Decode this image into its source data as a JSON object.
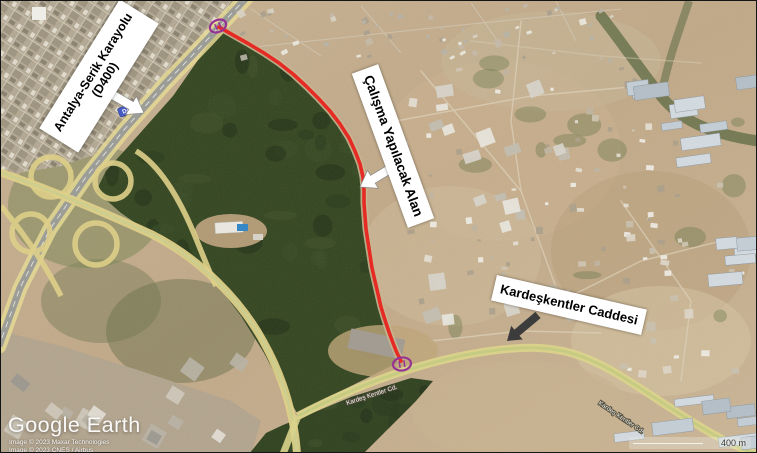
{
  "figure": {
    "callouts": {
      "highway": {
        "line1": "Antalya-Serik Karayolu",
        "line2": "(D400)"
      },
      "work_area": {
        "text": "Çalışma Yapılacak Alan"
      },
      "street": {
        "text": "Kardeşkentler Caddesi"
      }
    },
    "map": {
      "road_shield": "D400",
      "on_road_labels": [
        "Kardeş Kentler Cd.",
        "Kardeş Kentler Cd."
      ],
      "scale_label": "400 m",
      "watermark": "Google Earth",
      "attribution": [
        "Image © 2023 Maxar Technologies",
        "Image © 2023 CNES / Airbus"
      ]
    },
    "colors": {
      "route_highlight": "#e8231c",
      "marker_purple": "#942b93",
      "road_overlay_yellow": "#e0d187",
      "shield_blue": "#4056c5"
    }
  }
}
